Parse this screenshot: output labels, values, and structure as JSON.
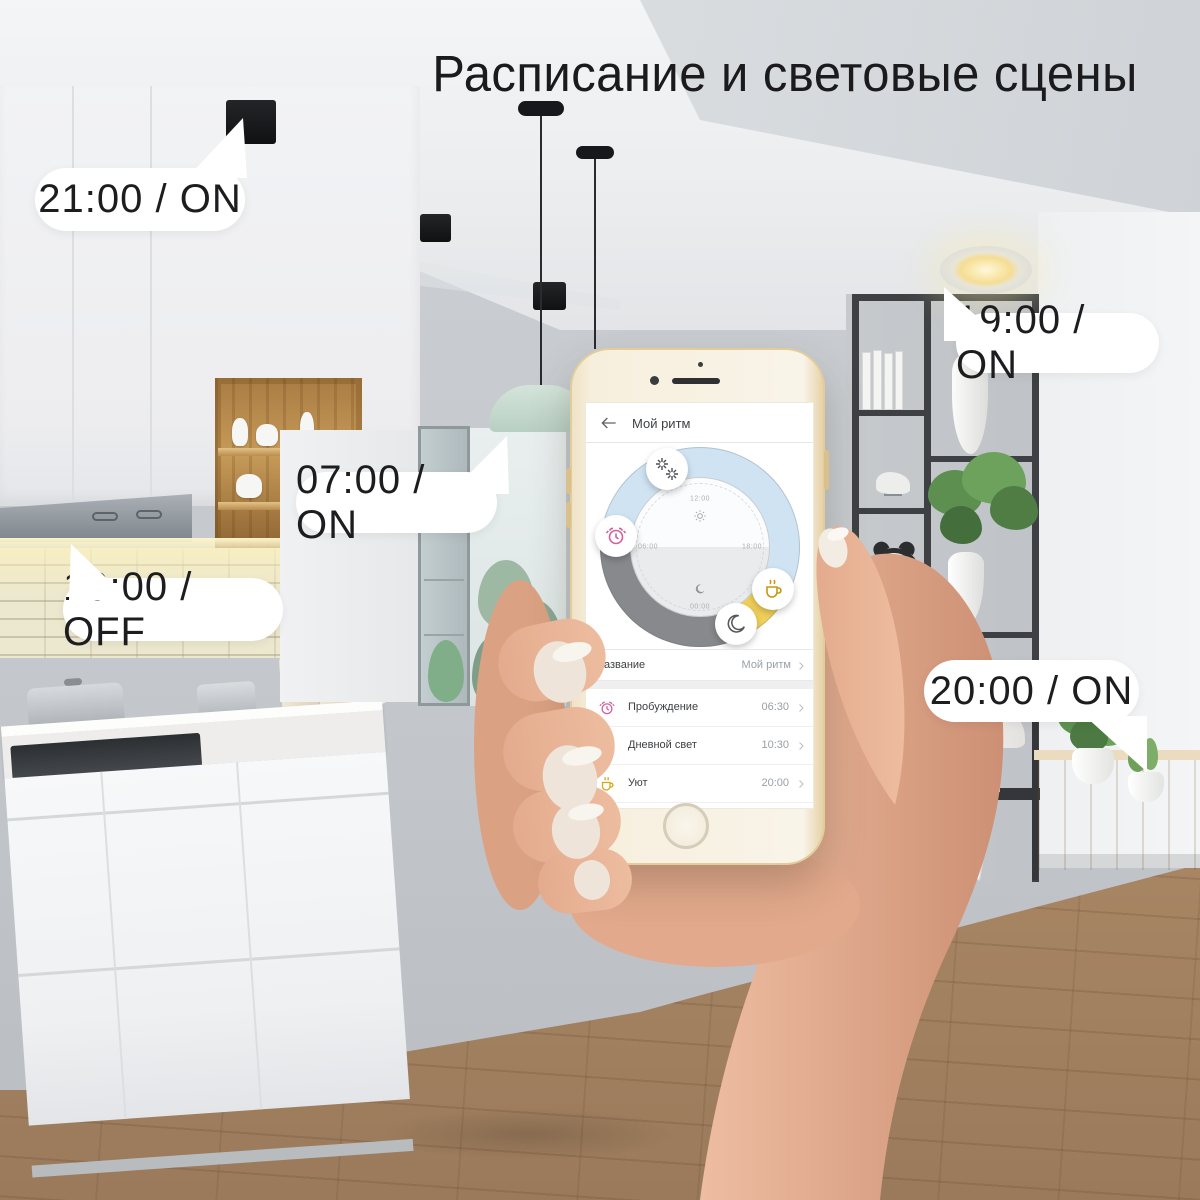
{
  "title": "Расписание и световые сцены",
  "callouts": [
    {
      "text": "21:00 / ON"
    },
    {
      "text": "07:00 / ON"
    },
    {
      "text": "10:00 / OFF"
    },
    {
      "text": "19:00 / ON"
    },
    {
      "text": "20:00 / ON"
    }
  ],
  "phone": {
    "app": {
      "header": {
        "title": "Мой ритм",
        "back_icon": "back-arrow-icon"
      },
      "dial": {
        "labels": {
          "top": "12:00",
          "right": "18:00",
          "bottom": "00:00",
          "left": "06:00"
        },
        "center_icons": [
          "sun-icon",
          "moon-icon"
        ],
        "segments": [
          {
            "name": "day",
            "color": "#cfe3f3"
          },
          {
            "name": "evening",
            "color": "#f0d059"
          },
          {
            "name": "night",
            "color": "#87898c"
          }
        ],
        "markers": [
          {
            "icon": "bright-light-icon",
            "time": "10:30"
          },
          {
            "icon": "alarm-icon",
            "time": "06:30"
          },
          {
            "icon": "cup-icon",
            "time": "20:00"
          },
          {
            "icon": "moon-icon",
            "time": "22:00"
          }
        ]
      },
      "name_row": {
        "label": "Название",
        "value": "Мой ритм"
      },
      "schedule": [
        {
          "icon": "alarm-icon",
          "label": "Пробуждение",
          "time": "06:30"
        },
        {
          "icon": "sun-icon",
          "label": "Дневной свет",
          "time": "10:30"
        },
        {
          "icon": "cup-icon",
          "label": "Уют",
          "time": "20:00"
        },
        {
          "icon": "moon-icon",
          "label": "Ночь",
          "time": "22:00"
        }
      ]
    }
  },
  "colors": {
    "accent_yellow": "#f0d059",
    "day_blue": "#cfe3f3",
    "night_gray": "#87898c",
    "alarm_pink": "#d45f9e",
    "cup_gold": "#c79a10",
    "phone_gold": "#e3cc9c"
  }
}
